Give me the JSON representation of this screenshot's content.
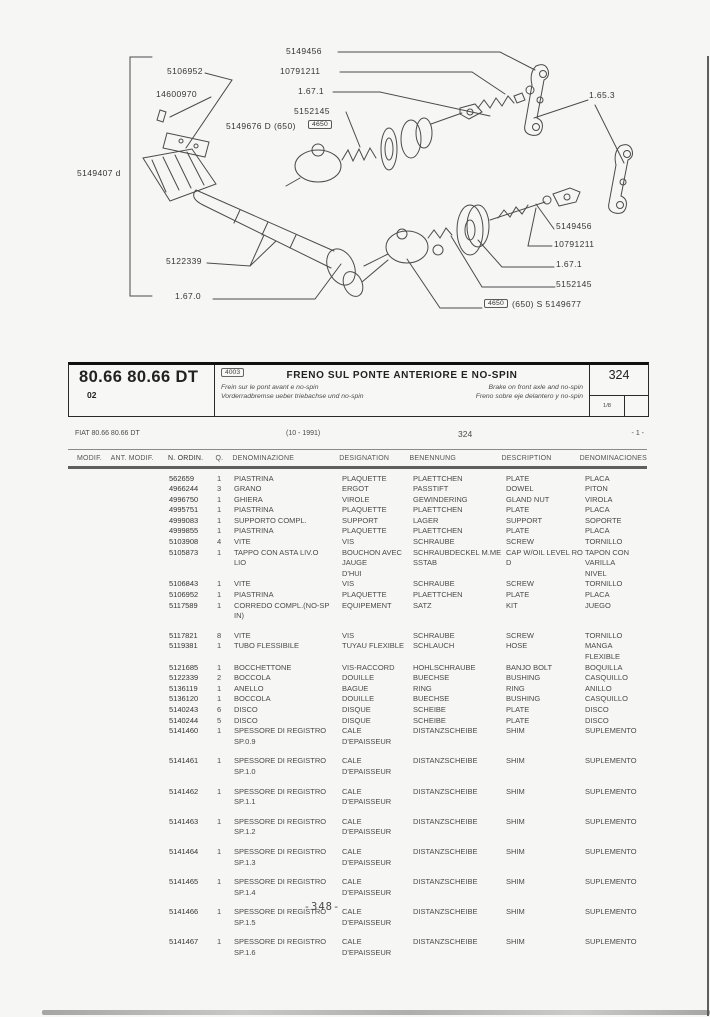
{
  "diagram": {
    "labels": [
      {
        "id": "lbl-5106952",
        "text": "5106952"
      },
      {
        "id": "lbl-14600970",
        "text": "14600970"
      },
      {
        "id": "lbl-5149456-top",
        "text": "5149456"
      },
      {
        "id": "lbl-10791211-top",
        "text": "10791211"
      },
      {
        "id": "lbl-1671-top",
        "text": "1.67.1"
      },
      {
        "id": "lbl-5152145-top",
        "text": "5152145"
      },
      {
        "id": "lbl-5149676",
        "text": "5149676  D  (650)"
      },
      {
        "id": "lbl-4650-top",
        "text": "4650",
        "boxed": true
      },
      {
        "id": "lbl-1653",
        "text": "1.65.3"
      },
      {
        "id": "lbl-5149407",
        "text": "5149407 d"
      },
      {
        "id": "lbl-5122339",
        "text": "5122339"
      },
      {
        "id": "lbl-1670",
        "text": "1.67.0"
      },
      {
        "id": "lbl-5149456-right",
        "text": "5149456"
      },
      {
        "id": "lbl-10791211-right",
        "text": "10791211"
      },
      {
        "id": "lbl-1671-right",
        "text": "1.67.1"
      },
      {
        "id": "lbl-5152145-right",
        "text": "5152145"
      },
      {
        "id": "lbl-4650-right",
        "text": "4650",
        "boxed": true
      },
      {
        "id": "lbl-5149677",
        "text": "(650)  S  5149677"
      }
    ]
  },
  "header": {
    "model": "80.66 80.66 DT",
    "model_sub": "02",
    "code": "4003",
    "title": "FRENO SUL PONTE ANTERIORE E NO-SPIN",
    "subtitle_fr": "Frein sur le pont avant e no-spin",
    "subtitle_de": "Vorderradbremse ueber triebachse und no-spin",
    "subtitle_en": "Brake on front axle and no-spin",
    "subtitle_es": "Freno sobre eje delantero y no-spin",
    "page_code": "324",
    "sheet": "1/8"
  },
  "info_row": {
    "left": "FIAT 80.66 80.66 DT",
    "date": "(10 - 1991)",
    "code": "324",
    "page_marker": "- 1 -"
  },
  "table": {
    "columns": [
      "MODIF.",
      "ANT. MODIF.",
      "N. ORDIN.",
      "Q.",
      "DENOMINAZIONE",
      "DESIGNATION",
      "BENENNUNG",
      "DESCRIPTION",
      "DENOMINACIONES"
    ],
    "rows": [
      {
        "n": "562659",
        "q": "1",
        "it": "PIASTRINA",
        "fr": "PLAQUETTE",
        "de": "PLAETTCHEN",
        "en": "PLATE",
        "es": "PLACA"
      },
      {
        "n": "4966244",
        "q": "3",
        "it": "GRANO",
        "fr": "ERGOT",
        "de": "PASSTIFT",
        "en": "DOWEL",
        "es": "PITON"
      },
      {
        "n": "4996750",
        "q": "1",
        "it": "GHIERA",
        "fr": "VIROLE",
        "de": "GEWINDERING",
        "en": "GLAND NUT",
        "es": "VIROLA"
      },
      {
        "n": "4995751",
        "q": "1",
        "it": "PIASTRINA",
        "fr": "PLAQUETTE",
        "de": "PLAETTCHEN",
        "en": "PLATE",
        "es": "PLACA"
      },
      {
        "n": "4999083",
        "q": "1",
        "it": "SUPPORTO COMPL.",
        "fr": "SUPPORT",
        "de": "LAGER",
        "en": "SUPPORT",
        "es": "SOPORTE"
      },
      {
        "n": "4999855",
        "q": "1",
        "it": "PIASTRINA",
        "fr": "PLAQUETTE",
        "de": "PLAETTCHEN",
        "en": "PLATE",
        "es": "PLACA"
      },
      {
        "n": "5103908",
        "q": "4",
        "it": "VITE",
        "fr": "VIS",
        "de": "SCHRAUBE",
        "en": "SCREW",
        "es": "TORNILLO"
      },
      {
        "n": "5105873",
        "q": "1",
        "it": "TAPPO CON ASTA LIV.O\nLIO",
        "fr": "BOUCHON AVEC JAUGE\nD'HUI",
        "de": "SCHRAUBDECKEL M.ME\nSSTAB",
        "en": "CAP W/OIL LEVEL RO\nD",
        "es": "TAPON CON VARILLA\nNIVEL"
      },
      {
        "n": "5106843",
        "q": "1",
        "it": "VITE",
        "fr": "VIS",
        "de": "SCHRAUBE",
        "en": "SCREW",
        "es": "TORNILLO"
      },
      {
        "n": "5106952",
        "q": "1",
        "it": "PIASTRINA",
        "fr": "PLAQUETTE",
        "de": "PLAETTCHEN",
        "en": "PLATE",
        "es": "PLACA"
      },
      {
        "n": "5117589",
        "q": "1",
        "it": "CORREDO COMPL.(NO-SP\nIN)",
        "fr": "EQUIPEMENT",
        "de": "SATZ",
        "en": "KIT",
        "es": "JUEGO",
        "gap": true
      },
      {
        "n": "5117821",
        "q": "8",
        "it": "VITE",
        "fr": "VIS",
        "de": "SCHRAUBE",
        "en": "SCREW",
        "es": "TORNILLO"
      },
      {
        "n": "5119381",
        "q": "1",
        "it": "TUBO FLESSIBILE",
        "fr": "TUYAU FLEXIBLE",
        "de": "SCHLAUCH",
        "en": "HOSE",
        "es": "MANGA FLEXIBLE"
      },
      {
        "n": "5121685",
        "q": "1",
        "it": "BOCCHETTONE",
        "fr": "VIS-RACCORD",
        "de": "HOHLSCHRAUBE",
        "en": "BANJO BOLT",
        "es": "BOQUILLA"
      },
      {
        "n": "5122339",
        "q": "2",
        "it": "BOCCOLA",
        "fr": "DOUILLE",
        "de": "BUECHSE",
        "en": "BUSHING",
        "es": "CASQUILLO"
      },
      {
        "n": "5136119",
        "q": "1",
        "it": "ANELLO",
        "fr": "BAGUE",
        "de": "RING",
        "en": "RING",
        "es": "ANILLO"
      },
      {
        "n": "5136120",
        "q": "1",
        "it": "BOCCOLA",
        "fr": "DOUILLE",
        "de": "BUECHSE",
        "en": "BUSHING",
        "es": "CASQUILLO"
      },
      {
        "n": "5140243",
        "q": "6",
        "it": "DISCO",
        "fr": "DISQUE",
        "de": "SCHEIBE",
        "en": "PLATE",
        "es": "DISCO"
      },
      {
        "n": "5140244",
        "q": "5",
        "it": "DISCO",
        "fr": "DISQUE",
        "de": "SCHEIBE",
        "en": "PLATE",
        "es": "DISCO"
      },
      {
        "n": "5141460",
        "q": "1",
        "it": "SPESSORE DI REGISTRO\nSP.0.9",
        "fr": "CALE D'EPAISSEUR",
        "de": "DISTANZSCHEIBE",
        "en": "SHIM",
        "es": "SUPLEMENTO",
        "gap": true
      },
      {
        "n": "5141461",
        "q": "1",
        "it": "SPESSORE DI REGISTRO\nSP.1.0",
        "fr": "CALE D'EPAISSEUR",
        "de": "DISTANZSCHEIBE",
        "en": "SHIM",
        "es": "SUPLEMENTO",
        "gap": true
      },
      {
        "n": "5141462",
        "q": "1",
        "it": "SPESSORE DI REGISTRO\nSP.1.1",
        "fr": "CALE D'EPAISSEUR",
        "de": "DISTANZSCHEIBE",
        "en": "SHIM",
        "es": "SUPLEMENTO",
        "gap": true
      },
      {
        "n": "5141463",
        "q": "1",
        "it": "SPESSORE DI REGISTRO\nSP.1.2",
        "fr": "CALE D'EPAISSEUR",
        "de": "DISTANZSCHEIBE",
        "en": "SHIM",
        "es": "SUPLEMENTO",
        "gap": true
      },
      {
        "n": "5141464",
        "q": "1",
        "it": "SPESSORE DI REGISTRO\nSP.1.3",
        "fr": "CALE D'EPAISSEUR",
        "de": "DISTANZSCHEIBE",
        "en": "SHIM",
        "es": "SUPLEMENTO",
        "gap": true
      },
      {
        "n": "5141465",
        "q": "1",
        "it": "SPESSORE DI REGISTRO\nSP.1.4",
        "fr": "CALE D'EPAISSEUR",
        "de": "DISTANZSCHEIBE",
        "en": "SHIM",
        "es": "SUPLEMENTO",
        "gap": true
      },
      {
        "n": "5141466",
        "q": "1",
        "it": "SPESSORE DI REGISTRO\nSP.1.5",
        "fr": "CALE D'EPAISSEUR",
        "de": "DISTANZSCHEIBE",
        "en": "SHIM",
        "es": "SUPLEMENTO",
        "gap": true
      },
      {
        "n": "5141467",
        "q": "1",
        "it": "SPESSORE DI REGISTRO\nSP.1.6",
        "fr": "CALE D'EPAISSEUR",
        "de": "DISTANZSCHEIBE",
        "en": "SHIM",
        "es": "SUPLEMENTO",
        "gap": true
      }
    ]
  },
  "footer": {
    "page_number": "-348-"
  }
}
